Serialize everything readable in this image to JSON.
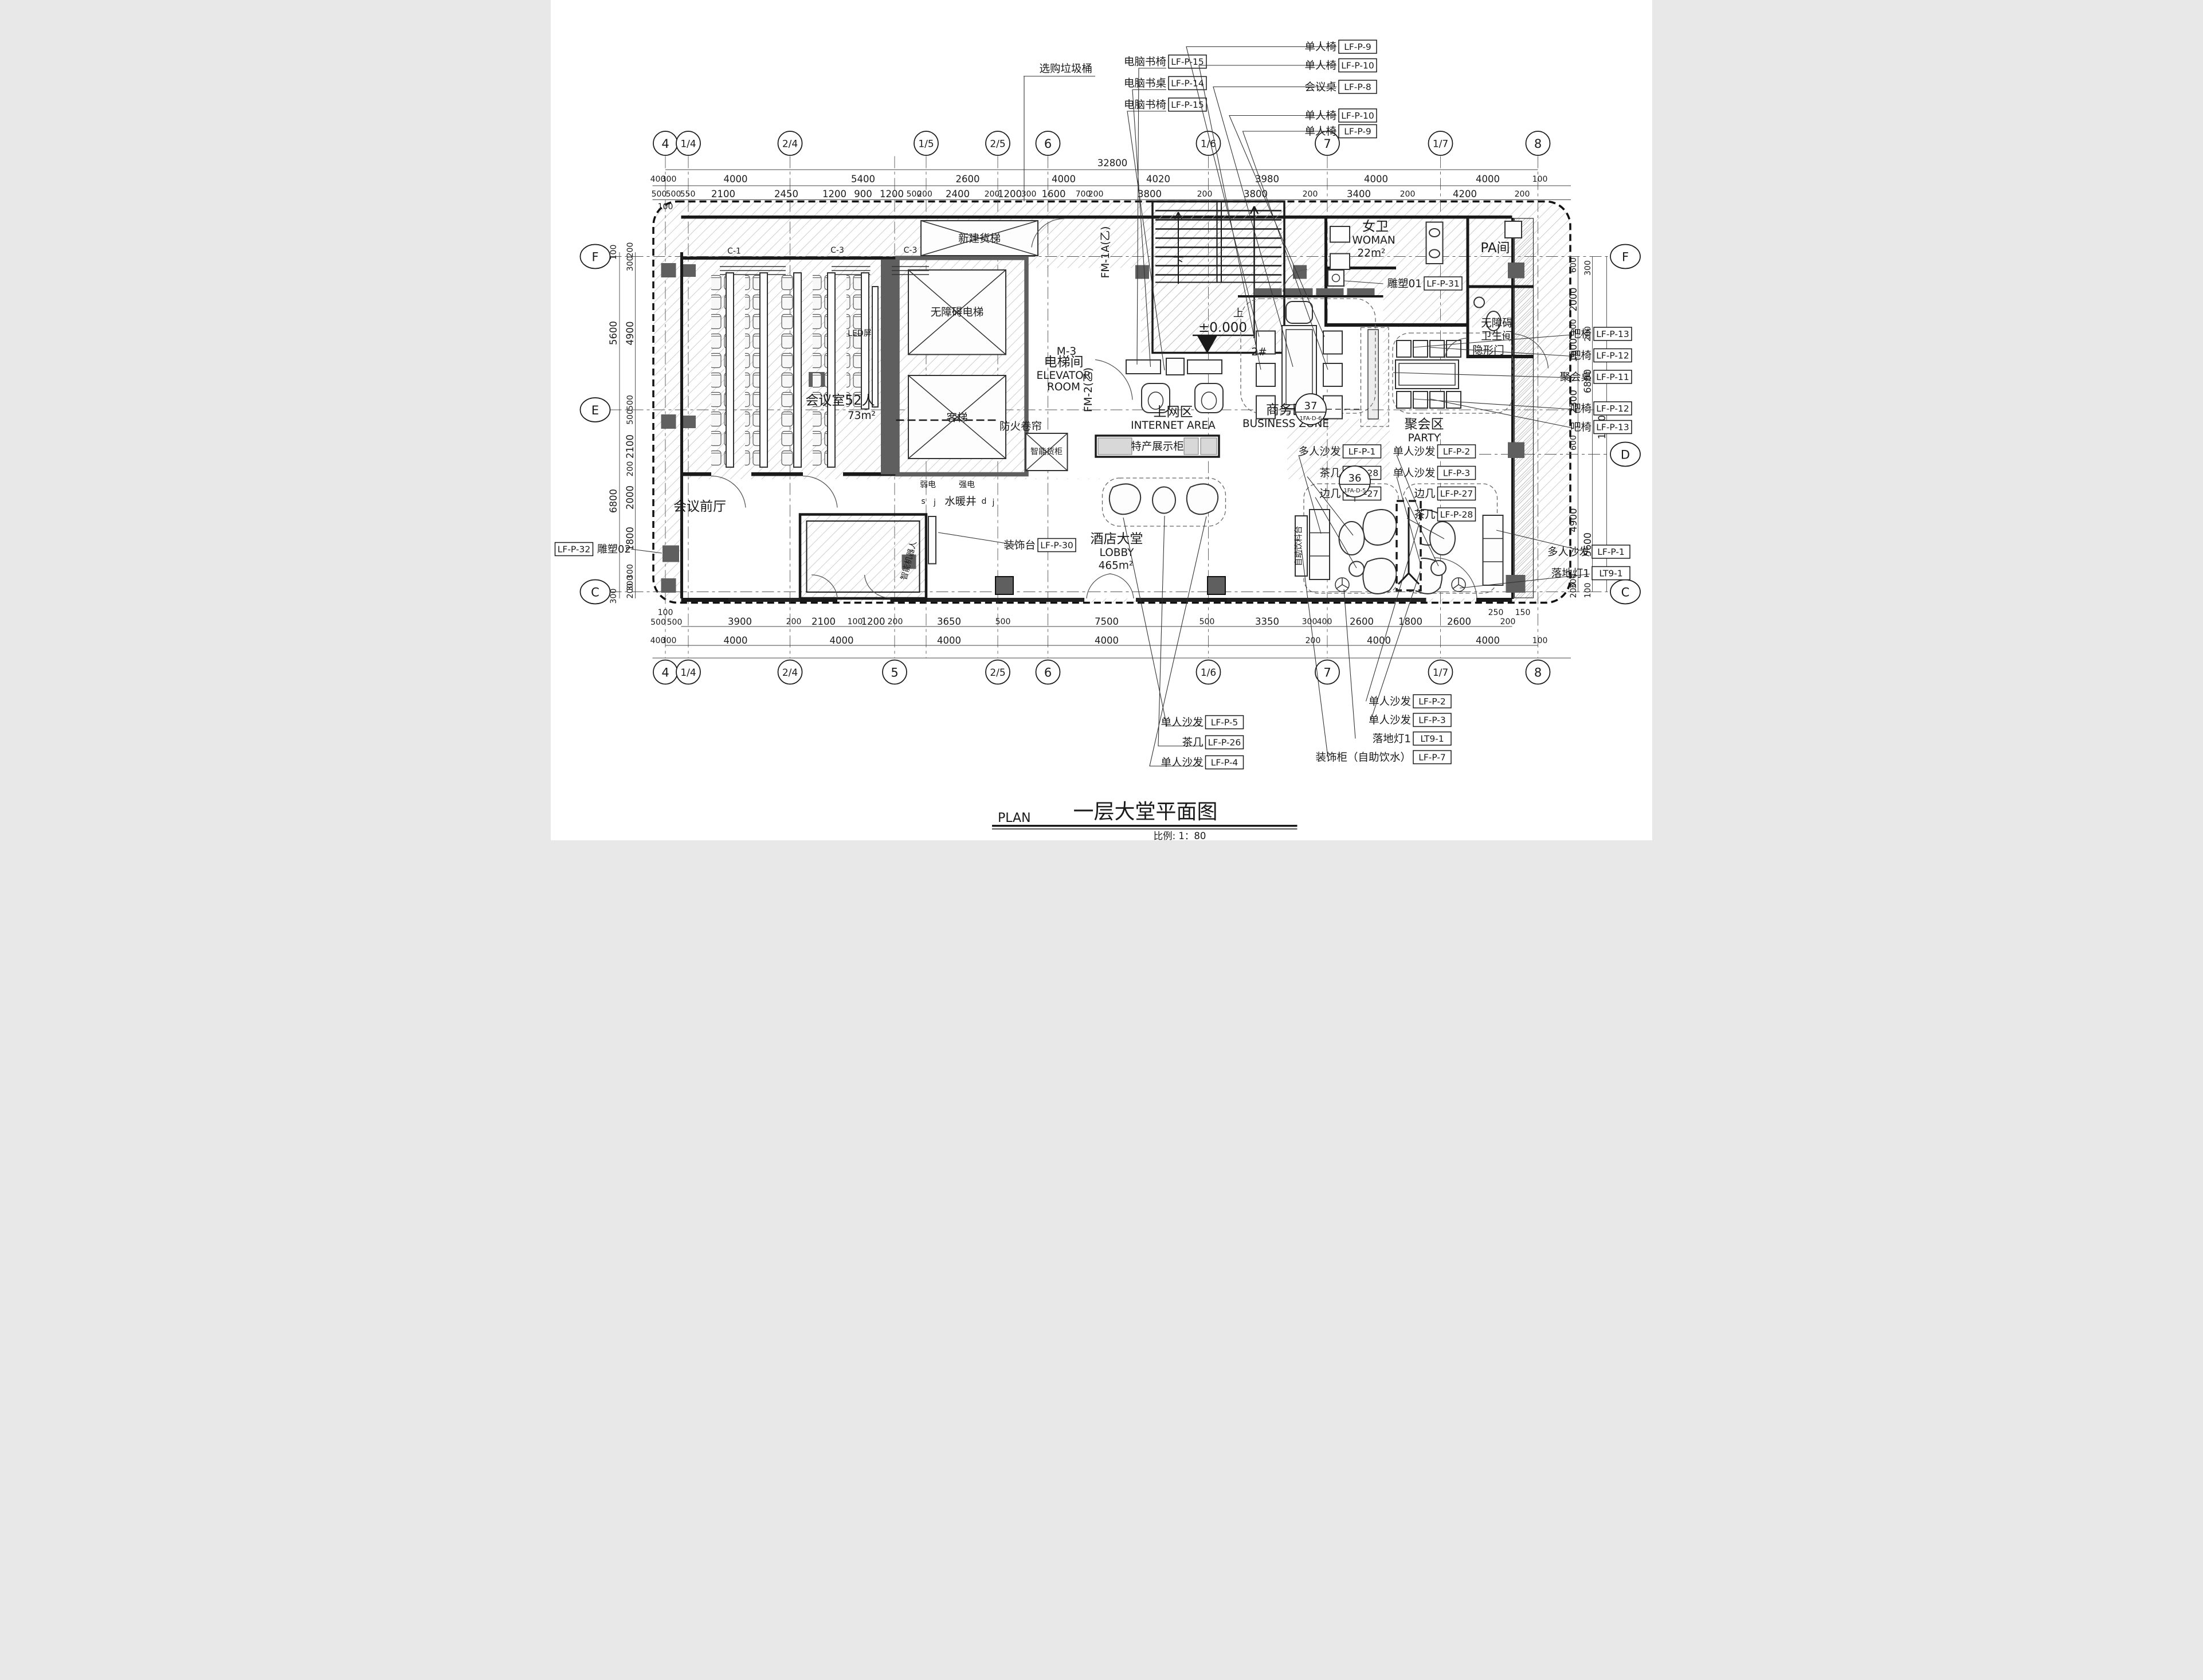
{
  "title_block": {
    "plan_label": "PLAN",
    "title": "一层大堂平面图",
    "scale": "比例: 1：80"
  },
  "grid_bubbles": {
    "top": [
      "4",
      "1/4",
      "2/4",
      "1/5",
      "2/5",
      "6",
      "1/6",
      "7",
      "1/7",
      "8"
    ],
    "bottom": [
      "4",
      "1/4",
      "2/4",
      "5",
      "2/5",
      "6",
      "1/6",
      "7",
      "1/7",
      "8"
    ],
    "left": [
      "F",
      "E",
      "C"
    ],
    "right": [
      "F",
      "D",
      "C"
    ]
  },
  "dimensions": {
    "top_overall": "32800",
    "top_grid": [
      "400",
      "300",
      "4000",
      "5400",
      "2600",
      "4000",
      "4020",
      "3980",
      "4000",
      "4000",
      "100"
    ],
    "top_detail": [
      "500",
      "500",
      "550",
      "2100",
      "2450",
      "1200",
      "900",
      "1200",
      "500",
      "200",
      "2400",
      "200",
      "1200",
      "300",
      "1600",
      "700",
      "200",
      "3800",
      "200",
      "3800",
      "200",
      "3400",
      "200",
      "4200",
      "200"
    ],
    "top_small": "100",
    "bottom_detail": [
      "100",
      "500",
      "500",
      "3900",
      "200",
      "2100",
      "100",
      "1200",
      "200",
      "3650",
      "500",
      "7500",
      "500",
      "3350",
      "300",
      "400",
      "2600",
      "1800",
      "2600",
      "250",
      "200",
      "150"
    ],
    "bottom_grid": [
      "400",
      "300",
      "4000",
      "4000",
      "4000",
      "4000",
      "200",
      "4000",
      "4000",
      "100"
    ],
    "left_outer": [
      "100",
      "5600",
      "6800",
      "300"
    ],
    "left_inner": [
      "200",
      "300",
      "4900",
      "500",
      "500",
      "2100",
      "200",
      "2000",
      "1800",
      "300",
      "300",
      "200"
    ],
    "right_col1": [
      "600",
      "2000",
      "100",
      "1600",
      "2300",
      "600",
      "4900",
      "300",
      "200"
    ],
    "right_col2": [
      "300",
      "200",
      "6800",
      "5600",
      "100"
    ],
    "right_overall": "12800"
  },
  "rooms": {
    "conference_name": "会议室52人",
    "conference_area": "73m²",
    "conference_front": "会议前厅",
    "elevator_zh": "电梯间",
    "elevator_en1": "ELEVATOR",
    "elevator_en2": "ROOM",
    "internet_zh": "上网区",
    "internet_en": "INTERNET AREA",
    "business_zh": "商务区",
    "business_en": "BUSINESS ZONE",
    "lobby_zh": "酒店大堂",
    "lobby_en": "LOBBY",
    "lobby_area": "465m²",
    "party_zh": "聚会区",
    "party_en": "PARTY",
    "woman_zh": "女卫",
    "woman_en": "WOMAN",
    "woman_area": "22m²",
    "pa_room": "PA间",
    "accessible_wc_1": "无障碍",
    "accessible_wc_2": "卫生间",
    "accessible_lift": "无障碍电梯",
    "passenger_lift": "客梯",
    "freight_lift": "新建货梯",
    "fire_shutter": "防火卷帘",
    "weak_power": "弱电",
    "strong_power": "强电",
    "plumbing_shaft": "水暖井",
    "shaft_letters": {
      "s": "s",
      "j": "j",
      "d": "d",
      "j2": "j"
    },
    "led_screen": "LED屏",
    "hidden_door": "隐形门",
    "smart_locker": "智能货柜",
    "display_cabinet": "特产展示柜",
    "drink_counter": "自助饮料台",
    "robot": "智能机器人",
    "finish_c1": "C-1",
    "finish_c3a": "C-3",
    "finish_c3b": "C-3"
  },
  "stair": {
    "down": "下",
    "up": "上",
    "level": "±0.000",
    "num": "2#"
  },
  "doors": {
    "m3": "M-3",
    "fm2": "FM-2(乙)",
    "fm1a": "FM-1A(乙)"
  },
  "callouts": {
    "trash": "选购垃圾桶",
    "top_center": [
      {
        "label": "电脑书椅",
        "code": "LF-P-15"
      },
      {
        "label": "电脑书桌",
        "code": "LF-P-14"
      },
      {
        "label": "电脑书椅",
        "code": "LF-P-15"
      }
    ],
    "top_right": [
      {
        "label": "单人椅",
        "code": "LF-P-9"
      },
      {
        "label": "单人椅",
        "code": "LF-P-10"
      },
      {
        "label": "会议桌",
        "code": "LF-P-8"
      },
      {
        "label": "单人椅",
        "code": "LF-P-10"
      },
      {
        "label": "单人椅",
        "code": "LF-P-9"
      }
    ],
    "right_top": [
      {
        "label": "吧椅",
        "code": "LF-P-13"
      },
      {
        "label": "吧椅",
        "code": "LF-P-12"
      },
      {
        "label": "聚会桌",
        "code": "LF-P-11"
      },
      {
        "label": "吧椅",
        "code": "LF-P-12"
      },
      {
        "label": "吧椅",
        "code": "LF-P-13"
      }
    ],
    "right_bottom": [
      {
        "label": "多人沙发",
        "code": "LF-P-1"
      },
      {
        "label": "落地灯1",
        "code": "LT9-1"
      }
    ],
    "left_edge": {
      "code": "LF-P-32",
      "label": "雕塑02"
    },
    "sculpture01": {
      "label": "雕塑01",
      "code": "LF-P-31"
    },
    "console": {
      "label": "装饰台",
      "code": "LF-P-30"
    },
    "sofa_left": [
      {
        "label": "多人沙发",
        "code": "LF-P-1"
      },
      {
        "label": "茶几",
        "code": "LF-P-28"
      },
      {
        "label": "边几",
        "code": "LF-P-27"
      }
    ],
    "sofa_right": [
      {
        "label": "单人沙发",
        "code": "LF-P-2"
      },
      {
        "label": "单人沙发",
        "code": "LF-P-3"
      },
      {
        "label": "边几",
        "code": "LF-P-27"
      },
      {
        "label": "茶几",
        "code": "LF-P-28"
      }
    ],
    "bottom_left": [
      {
        "label": "单人沙发",
        "code": "LF-P-5"
      },
      {
        "label": "茶几",
        "code": "LF-P-26"
      },
      {
        "label": "单人沙发",
        "code": "LF-P-4"
      }
    ],
    "bottom_right": [
      {
        "label": "单人沙发",
        "code": "LF-P-2"
      },
      {
        "label": "单人沙发",
        "code": "LF-P-3"
      },
      {
        "label": "落地灯1",
        "code": "LT9-1"
      },
      {
        "label": "装饰柜（自助饮水）",
        "code": "LF-P-7"
      }
    ],
    "circle36": {
      "num": "36",
      "ref": "1FA-D-5"
    },
    "circle37": {
      "num": "37",
      "ref": "1FA-D-6"
    }
  }
}
